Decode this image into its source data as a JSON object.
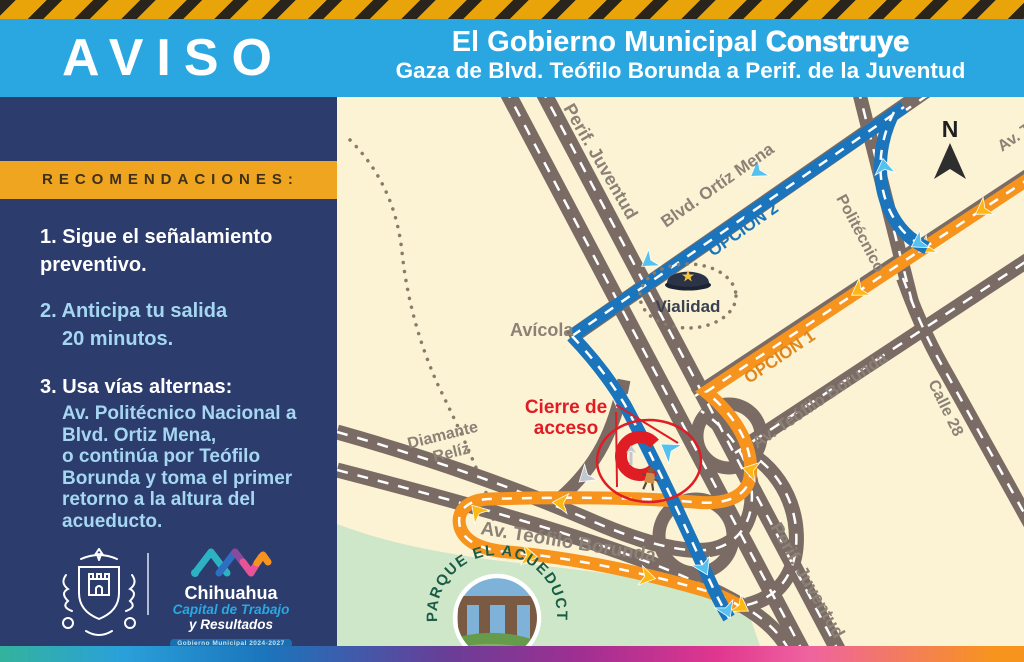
{
  "header": {
    "badge": "AVISO",
    "title_normal": "El Gobierno Municipal ",
    "title_bold": "Construye",
    "subtitle": "Gaza de Blvd. Teófilo Borunda a Perif. de la Juventud"
  },
  "sidebar": {
    "band": "RECOMENDACIONES:",
    "items": [
      {
        "lines": [
          "1. Sigue el señalamiento",
          "preventivo."
        ]
      },
      {
        "lines": [
          "2. Anticipa tu salida",
          "20 minutos."
        ]
      },
      {
        "lines": [
          "3. Usa vías alternas:"
        ]
      },
      {
        "lines": [
          "Av. Politécnico Nacional a",
          "Blvd. Ortiz Mena,",
          "o continúa por Teófilo",
          "Borunda y toma el primer",
          "retorno a la altura del",
          "acueducto."
        ]
      }
    ],
    "logo": {
      "name": "Chihuahua",
      "tagline1": "Capital de Trabajo",
      "tagline2": "y Resultados",
      "banner": "Gobierno Municipal 2024-2027"
    }
  },
  "map": {
    "labels": {
      "north": "N",
      "perif_top": "Perif. Juventud",
      "perif_bottom": "Perif. Juventud",
      "ortiz": "Blvd. Ortíz Mena",
      "opcion2": "OPCIÓN 2",
      "opcion1": "OPCIÓN 1",
      "politecnico": "Politécnico",
      "calle28": "Calle 28",
      "teofilo_diag": "Av. Teófilo Borunda",
      "teofilo_diag2": "Av. Teófilo Borunda",
      "teofilo_bottom": "Av. Teófilo Borunda",
      "avicola": "Avícola",
      "diamante_line1": "Diamante",
      "diamante_line2": "Relíz",
      "vialidad": "Vialidad",
      "cierre_line1": "Cierre de",
      "cierre_line2": "acceso",
      "parque": "PARQUE EL ACUEDUCTO"
    },
    "colors": {
      "route_option1": "#f7941e",
      "route_option2": "#1b75bc",
      "closure_red": "#e01c24",
      "road": "#7a6b64",
      "map_background": "#fbf3d3",
      "park_green": "#cfe7c9",
      "header_blue": "#2aa7e0",
      "sidebar_navy": "#2c3c6c",
      "band_yellow": "#efa51f"
    }
  }
}
